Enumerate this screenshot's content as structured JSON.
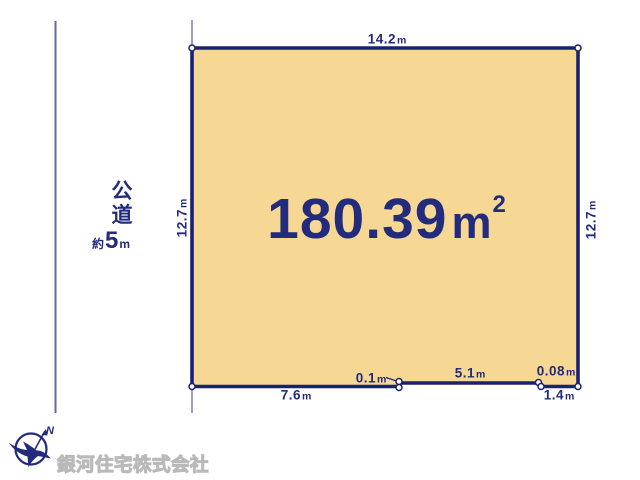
{
  "plot": {
    "area": {
      "value": "180.39",
      "unit": "m",
      "sup": "2"
    }
  },
  "dims": {
    "top": {
      "value": "14.2",
      "unit": "m"
    },
    "left": {
      "value": "12.7",
      "unit": "m"
    },
    "right": {
      "value": "12.7",
      "unit": "m"
    },
    "bottom_left": {
      "value": "7.6",
      "unit": "m"
    },
    "step_left": {
      "value": "0.1",
      "unit": "m"
    },
    "bottom_mid": {
      "value": "5.1",
      "unit": "m"
    },
    "step_right": {
      "value": "0.08",
      "unit": "m"
    },
    "bottom_right": {
      "value": "1.4",
      "unit": "m"
    }
  },
  "road": {
    "name_chars": [
      "公",
      "道"
    ],
    "width_prefix": "約",
    "width_value": "5",
    "width_unit": "m"
  },
  "compass": {
    "north_label": "N"
  },
  "footer": {
    "company": "銀河住宅株式会社"
  },
  "colors": {
    "navy": "#232b7c",
    "border": "#1b2172",
    "plot_fill": "#f6d794",
    "road_line": "#6a6a9c",
    "marker_fill": "#ffffff",
    "watermark_stroke": "#b9b9b9",
    "watermark_fill": "#ebebeb"
  }
}
